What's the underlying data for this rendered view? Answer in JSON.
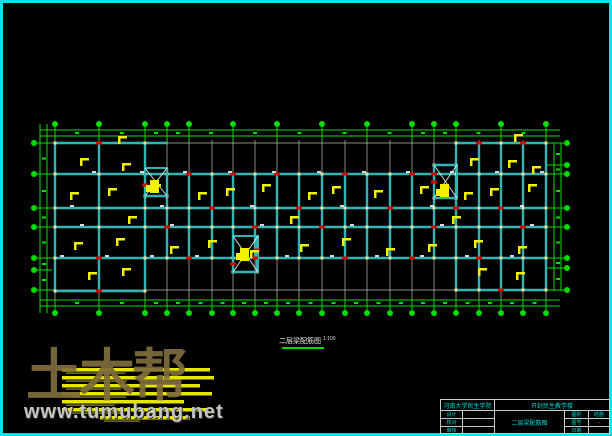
{
  "plan_title": {
    "text": "二层梁配筋图",
    "scale": "1:100"
  },
  "watermark": {
    "brand": "土木帮",
    "site": "www.tumubang.net"
  },
  "title_block": {
    "org": "河南大学民生学院",
    "project": "开封民生教学楼",
    "drawing_name": "二层梁配筋图",
    "left_rows": [
      {
        "label": "设计",
        "value": ""
      },
      {
        "label": "校对",
        "value": ""
      },
      {
        "label": "审核",
        "value": ""
      }
    ],
    "right_rows": [
      {
        "label": "图别",
        "value": "结施"
      },
      {
        "label": "图号",
        "value": "-"
      },
      {
        "label": "日期",
        "value": ""
      }
    ]
  },
  "colors": {
    "border": "#00e6e6",
    "grid": "#c4c4c4",
    "green": "#00dc00",
    "beam": "#32b4b4",
    "node": "#e6e0a0",
    "red": "#d80000",
    "yellow": "#f2f200",
    "white": "#f0f0f0",
    "cyan_text": "#00d8d8"
  },
  "drawing": {
    "frame": [
      1.5,
      1.5,
      609,
      433
    ],
    "grid": {
      "xs": [
        55,
        99,
        145,
        167,
        189,
        212,
        233,
        255,
        277,
        299,
        322,
        345,
        367,
        390,
        412,
        434,
        456,
        479,
        501,
        523,
        546
      ],
      "ys": [
        143,
        174,
        208,
        227,
        258,
        290
      ],
      "vspan": [
        140,
        308
      ],
      "hspan": [
        40,
        560
      ]
    },
    "dimlines": {
      "top_ys": [
        130,
        136
      ],
      "bottom_ys": [
        300,
        306
      ],
      "left_xs": [
        40,
        47
      ],
      "right_xs": [
        554,
        561
      ],
      "h_span": [
        40,
        560
      ],
      "left_vspan": [
        124,
        313
      ],
      "right_vspan": [
        143,
        291
      ]
    },
    "bubbles": {
      "top": {
        "y": 124,
        "xs": [
          55,
          99,
          145,
          167,
          189,
          233,
          277,
          322,
          367,
          412,
          434,
          456,
          501,
          546
        ]
      },
      "bottom": {
        "y": 313,
        "xs": [
          55,
          99,
          145,
          167,
          189,
          212,
          233,
          255,
          277,
          299,
          322,
          345,
          367,
          390,
          412,
          434,
          456,
          479,
          501,
          523,
          546
        ]
      },
      "left": {
        "x": 34,
        "ys": [
          143,
          174,
          208,
          227,
          258,
          270,
          290
        ]
      },
      "right": {
        "x": 567,
        "ys": [
          143,
          165,
          174,
          208,
          227,
          258,
          268,
          290
        ]
      }
    },
    "beams": {
      "h": [
        [
          55,
          143,
          168
        ],
        [
          456,
          143,
          547
        ],
        [
          434,
          165,
          457
        ],
        [
          55,
          174,
          547
        ],
        [
          55,
          208,
          547
        ],
        [
          55,
          227,
          547
        ],
        [
          55,
          258,
          547
        ],
        [
          55,
          291,
          145
        ],
        [
          456,
          290,
          547
        ],
        [
          233,
          272,
          258
        ],
        [
          145,
          196,
          167
        ],
        [
          434,
          198,
          456
        ]
      ],
      "v": [
        [
          55,
          143,
          291
        ],
        [
          99,
          143,
          291
        ],
        [
          145,
          143,
          291
        ],
        [
          167,
          168,
          258
        ],
        [
          189,
          174,
          258
        ],
        [
          212,
          174,
          258
        ],
        [
          233,
          174,
          258
        ],
        [
          255,
          174,
          258
        ],
        [
          277,
          174,
          258
        ],
        [
          299,
          174,
          258
        ],
        [
          322,
          174,
          258
        ],
        [
          345,
          174,
          258
        ],
        [
          367,
          174,
          258
        ],
        [
          390,
          174,
          258
        ],
        [
          412,
          174,
          258
        ],
        [
          434,
          165,
          258
        ],
        [
          456,
          143,
          290
        ],
        [
          479,
          143,
          290
        ],
        [
          501,
          143,
          290
        ],
        [
          523,
          143,
          290
        ],
        [
          546,
          143,
          290
        ],
        [
          233,
          258,
          272
        ],
        [
          257,
          236,
          272
        ]
      ]
    },
    "stairs": [
      [
        145,
        168,
        22,
        28
      ],
      [
        434,
        165,
        23,
        33
      ],
      [
        233,
        236,
        25,
        36
      ]
    ],
    "red_marks": [
      [
        99,
        143
      ],
      [
        479,
        143
      ],
      [
        523,
        143
      ],
      [
        189,
        174
      ],
      [
        233,
        174
      ],
      [
        277,
        174
      ],
      [
        345,
        174
      ],
      [
        412,
        174
      ],
      [
        434,
        174
      ],
      [
        212,
        208
      ],
      [
        299,
        208
      ],
      [
        390,
        208
      ],
      [
        456,
        208
      ],
      [
        501,
        208
      ],
      [
        167,
        227
      ],
      [
        255,
        227
      ],
      [
        322,
        227
      ],
      [
        434,
        227
      ],
      [
        523,
        227
      ],
      [
        99,
        258
      ],
      [
        189,
        258
      ],
      [
        255,
        258
      ],
      [
        345,
        258
      ],
      [
        412,
        258
      ],
      [
        479,
        258
      ],
      [
        99,
        291
      ],
      [
        501,
        290
      ],
      [
        145,
        185
      ],
      [
        434,
        182
      ],
      [
        233,
        264
      ],
      [
        257,
        250
      ]
    ],
    "yellow_flags": [
      [
        118,
        136
      ],
      [
        514,
        134
      ],
      [
        80,
        158
      ],
      [
        122,
        163
      ],
      [
        470,
        158
      ],
      [
        508,
        160
      ],
      [
        532,
        166
      ],
      [
        70,
        192
      ],
      [
        108,
        188
      ],
      [
        152,
        184
      ],
      [
        198,
        192
      ],
      [
        226,
        188
      ],
      [
        262,
        184
      ],
      [
        308,
        192
      ],
      [
        332,
        186
      ],
      [
        374,
        190
      ],
      [
        420,
        186
      ],
      [
        464,
        192
      ],
      [
        490,
        188
      ],
      [
        528,
        184
      ],
      [
        128,
        216
      ],
      [
        290,
        216
      ],
      [
        452,
        216
      ],
      [
        74,
        242
      ],
      [
        116,
        238
      ],
      [
        170,
        246
      ],
      [
        208,
        240
      ],
      [
        250,
        250
      ],
      [
        300,
        244
      ],
      [
        342,
        238
      ],
      [
        386,
        248
      ],
      [
        428,
        244
      ],
      [
        474,
        240
      ],
      [
        518,
        246
      ],
      [
        88,
        272
      ],
      [
        122,
        268
      ],
      [
        478,
        268
      ],
      [
        516,
        272
      ]
    ],
    "yellow_big": [
      [
        150,
        180
      ],
      [
        240,
        248
      ],
      [
        440,
        184
      ]
    ],
    "white_ticks": [
      [
        92,
        171
      ],
      [
        140,
        171
      ],
      [
        183,
        171
      ],
      [
        228,
        171
      ],
      [
        272,
        171
      ],
      [
        317,
        171
      ],
      [
        362,
        171
      ],
      [
        406,
        171
      ],
      [
        450,
        171
      ],
      [
        495,
        171
      ],
      [
        540,
        171
      ],
      [
        60,
        255
      ],
      [
        105,
        255
      ],
      [
        150,
        255
      ],
      [
        195,
        255
      ],
      [
        240,
        255
      ],
      [
        285,
        255
      ],
      [
        330,
        255
      ],
      [
        375,
        255
      ],
      [
        420,
        255
      ],
      [
        465,
        255
      ],
      [
        510,
        255
      ],
      [
        70,
        205
      ],
      [
        160,
        205
      ],
      [
        250,
        205
      ],
      [
        340,
        205
      ],
      [
        430,
        205
      ],
      [
        520,
        205
      ],
      [
        80,
        224
      ],
      [
        170,
        224
      ],
      [
        260,
        224
      ],
      [
        350,
        224
      ],
      [
        440,
        224
      ],
      [
        530,
        224
      ]
    ],
    "notes_lines": [
      [
        62,
        368,
        148
      ],
      [
        62,
        376,
        152
      ],
      [
        62,
        384,
        138
      ],
      [
        62,
        392,
        150
      ],
      [
        62,
        400,
        122
      ],
      [
        62,
        408,
        146
      ],
      [
        100,
        416,
        90
      ]
    ],
    "title_underline": [
      282,
      348,
      324,
      348
    ]
  }
}
